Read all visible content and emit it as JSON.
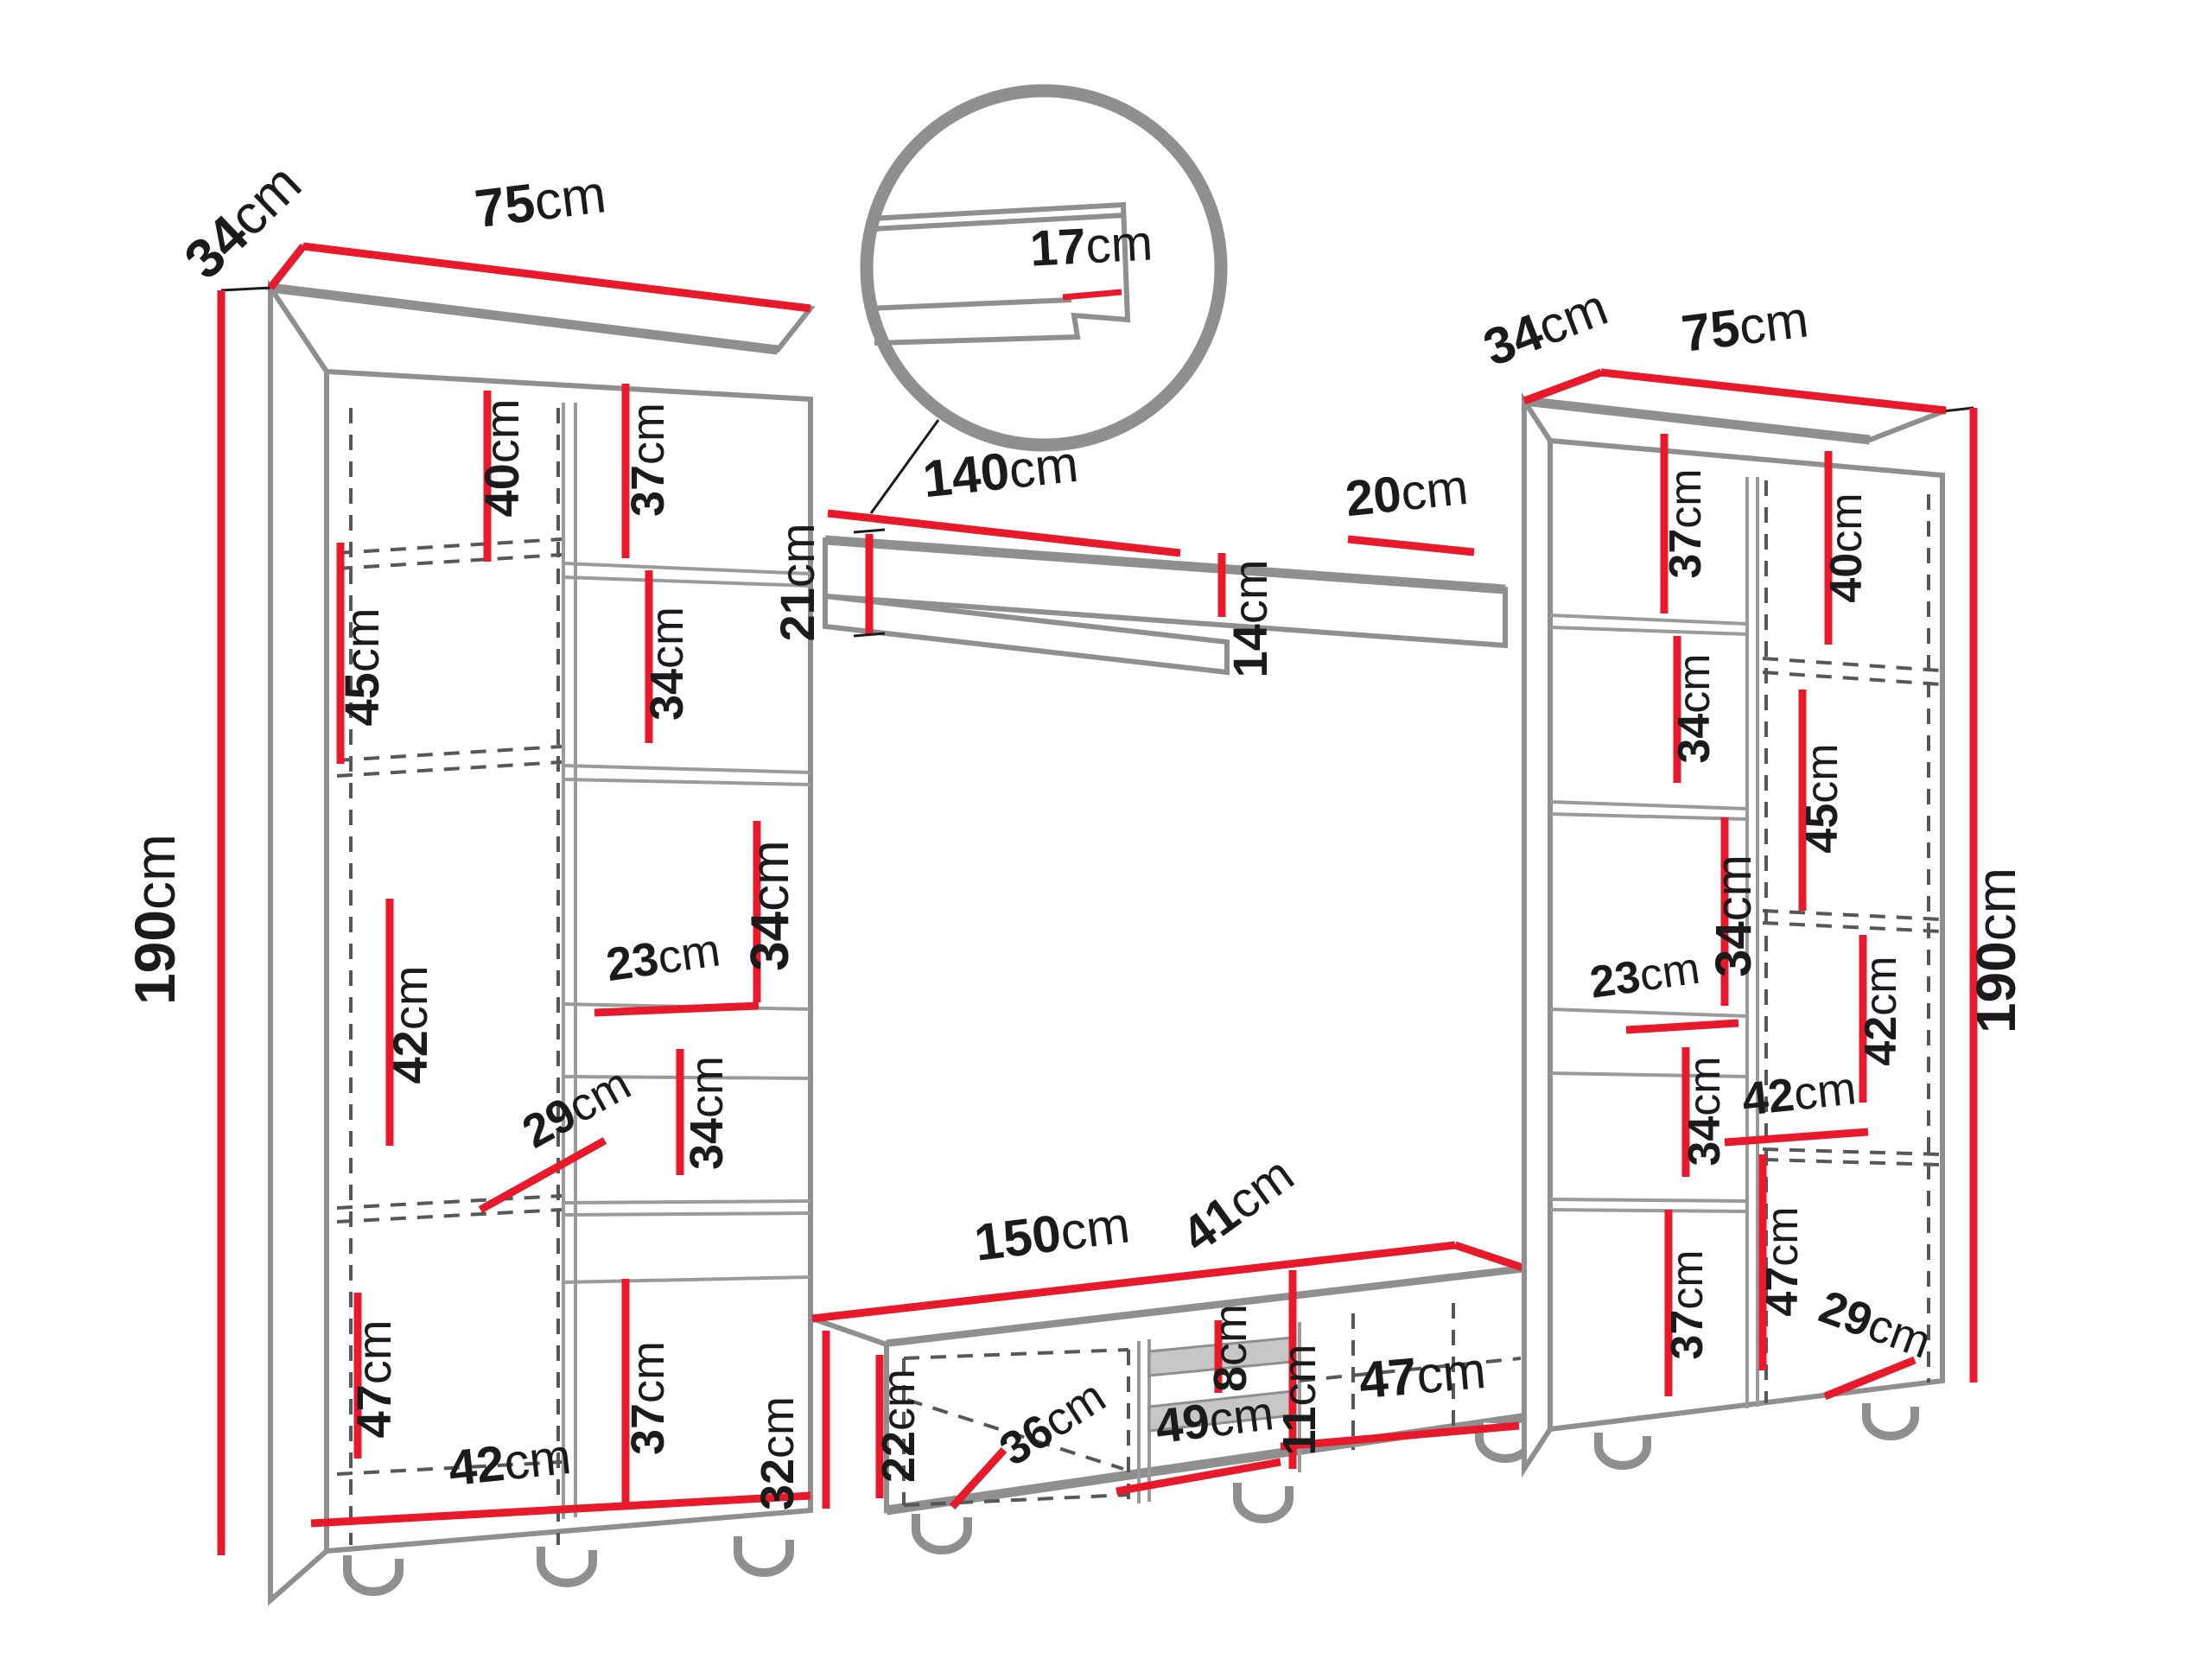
{
  "colors": {
    "dimension_red": "#e8192b",
    "outline_gray": "#8f8f8f",
    "dashed_gray": "#575757",
    "label_black": "#1b1b1b",
    "background": "#ffffff"
  },
  "left_cabinet": {
    "width": {
      "v": "75",
      "u": "cm"
    },
    "depth": {
      "v": "34",
      "u": "cm"
    },
    "height": {
      "v": "190",
      "u": "cm"
    },
    "door_sections": [
      {
        "v": "40",
        "u": "cm"
      },
      {
        "v": "45",
        "u": "cm"
      },
      {
        "v": "42",
        "u": "cm"
      },
      {
        "v": "47",
        "u": "cm"
      }
    ],
    "shelf_sections": [
      {
        "v": "37",
        "u": "cm"
      },
      {
        "v": "34",
        "u": "cm"
      },
      {
        "v": "34",
        "u": "cm"
      },
      {
        "v": "23",
        "u": "cm"
      },
      {
        "v": "34",
        "u": "cm"
      },
      {
        "v": "37",
        "u": "cm"
      }
    ],
    "inner_depth": {
      "v": "29",
      "u": "cm"
    },
    "inner_width": {
      "v": "42",
      "u": "cm"
    }
  },
  "shelf_detail": {
    "lip_height": {
      "v": "17",
      "u": "cm"
    }
  },
  "wall_shelf": {
    "length": {
      "v": "140",
      "u": "cm"
    },
    "depth": {
      "v": "20",
      "u": "cm"
    },
    "outer_height": {
      "v": "21",
      "u": "cm"
    },
    "inner_height": {
      "v": "14",
      "u": "cm"
    }
  },
  "tv_stand": {
    "length": {
      "v": "150",
      "u": "cm"
    },
    "depth": {
      "v": "41",
      "u": "cm"
    },
    "height": {
      "v": "32",
      "u": "cm"
    },
    "left_section_height": {
      "v": "22",
      "u": "cm"
    },
    "inner_depth": {
      "v": "36",
      "u": "cm"
    },
    "upper_slot_height": {
      "v": "8",
      "u": "cm"
    },
    "lower_slot_height": {
      "v": "11",
      "u": "cm"
    },
    "middle_section_width": {
      "v": "49",
      "u": "cm"
    },
    "right_section_width": {
      "v": "47",
      "u": "cm"
    }
  },
  "right_cabinet": {
    "width": {
      "v": "75",
      "u": "cm"
    },
    "depth": {
      "v": "34",
      "u": "cm"
    },
    "height": {
      "v": "190",
      "u": "cm"
    },
    "shelf_sections": [
      {
        "v": "37",
        "u": "cm"
      },
      {
        "v": "34",
        "u": "cm"
      },
      {
        "v": "34",
        "u": "cm"
      },
      {
        "v": "23",
        "u": "cm"
      },
      {
        "v": "34",
        "u": "cm"
      },
      {
        "v": "37",
        "u": "cm"
      }
    ],
    "door_sections": [
      {
        "v": "40",
        "u": "cm"
      },
      {
        "v": "45",
        "u": "cm"
      },
      {
        "v": "42",
        "u": "cm"
      },
      {
        "v": "47",
        "u": "cm"
      }
    ],
    "inner_width": {
      "v": "42",
      "u": "cm"
    },
    "inner_depth": {
      "v": "29",
      "u": "cm"
    }
  }
}
